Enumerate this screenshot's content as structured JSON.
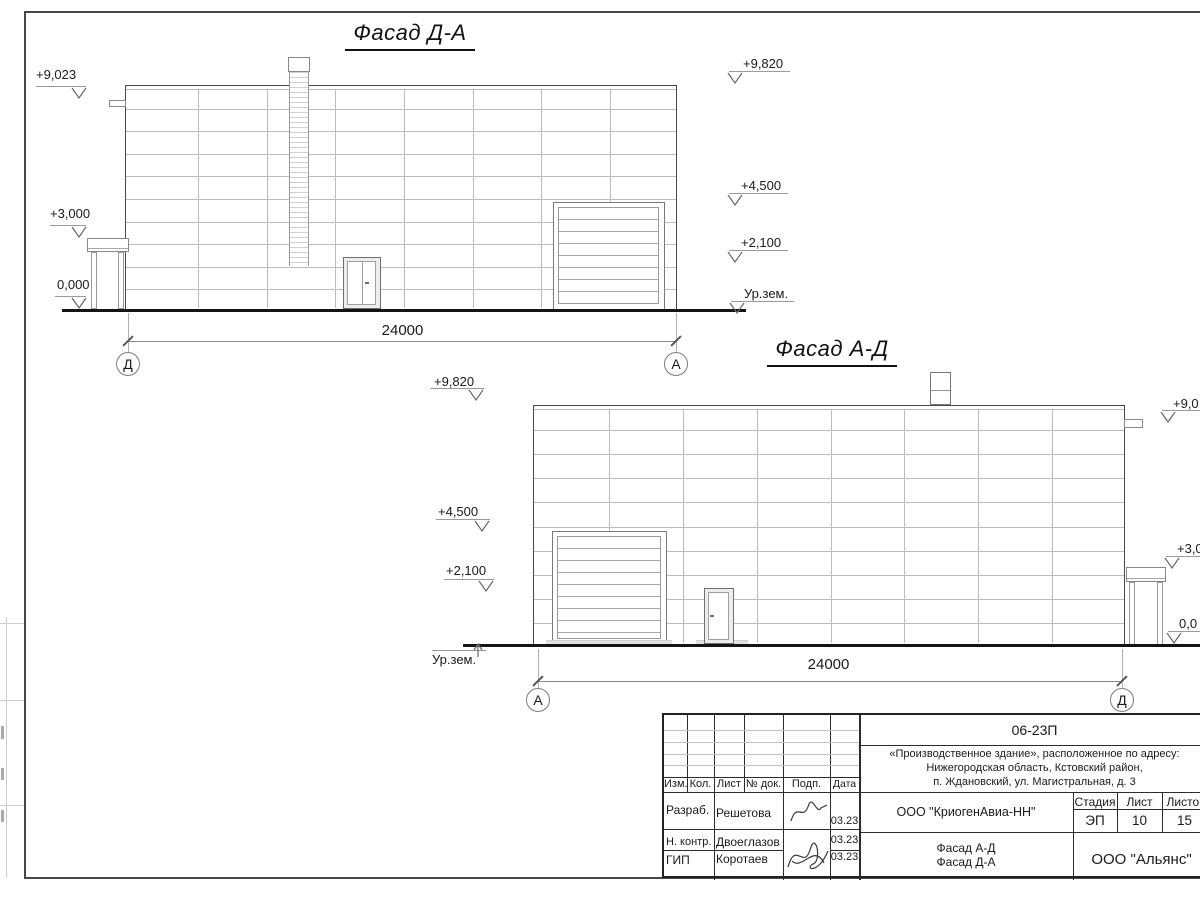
{
  "facade1": {
    "title": "Фасад Д-А",
    "dimension": "24000",
    "axis_left": "Д",
    "axis_right": "А",
    "marks_left": [
      {
        "label": "+9,023"
      },
      {
        "label": "+3,000"
      },
      {
        "label": "0,000"
      }
    ],
    "marks_right": [
      {
        "label": "+9,820"
      },
      {
        "label": "+4,500"
      },
      {
        "label": "+2,100"
      },
      {
        "label": "Ур.зем."
      }
    ]
  },
  "facade2": {
    "title": "Фасад А-Д",
    "dimension": "24000",
    "axis_left": "А",
    "axis_right": "Д",
    "marks_left": [
      {
        "label": "+9,820"
      },
      {
        "label": "+4,500"
      },
      {
        "label": "+2,100"
      },
      {
        "label": "Ур.зем."
      }
    ],
    "marks_right": [
      {
        "label": "+9,0"
      },
      {
        "label": "+3,0"
      },
      {
        "label": "0,0"
      }
    ]
  },
  "title_block": {
    "doc_number": "06-23П",
    "project_address_lines": [
      "«Производственное здание», расположенное по адресу:",
      "Нижегородская область, Кстовский район,",
      "п. Ждановский, ул. Магистральная, д. 3"
    ],
    "columns": {
      "izm": "Изм.",
      "kol": "Кол.",
      "list": "Лист",
      "doc": "№ док.",
      "podp": "Подп.",
      "data": "Дата"
    },
    "rows": [
      {
        "role": "Разраб.",
        "name": "Решетова",
        "date": "03.23"
      },
      {
        "role": "Н. контр.",
        "name": "Двоеглазов",
        "date": "03.23"
      },
      {
        "role": "ГИП",
        "name": "Коротаев",
        "date": "03.23"
      }
    ],
    "designer_company": "ООО \"КриогенАвиа-НН\"",
    "stage_label": "Стадия",
    "sheet_label": "Лист",
    "sheets_label": "Листов",
    "stage": "ЭП",
    "sheet_no": "10",
    "sheets_total": "15",
    "sheet_title_lines": [
      "Фасад А-Д",
      "Фасад Д-А"
    ],
    "contractor": "ООО \"Альянс\""
  }
}
